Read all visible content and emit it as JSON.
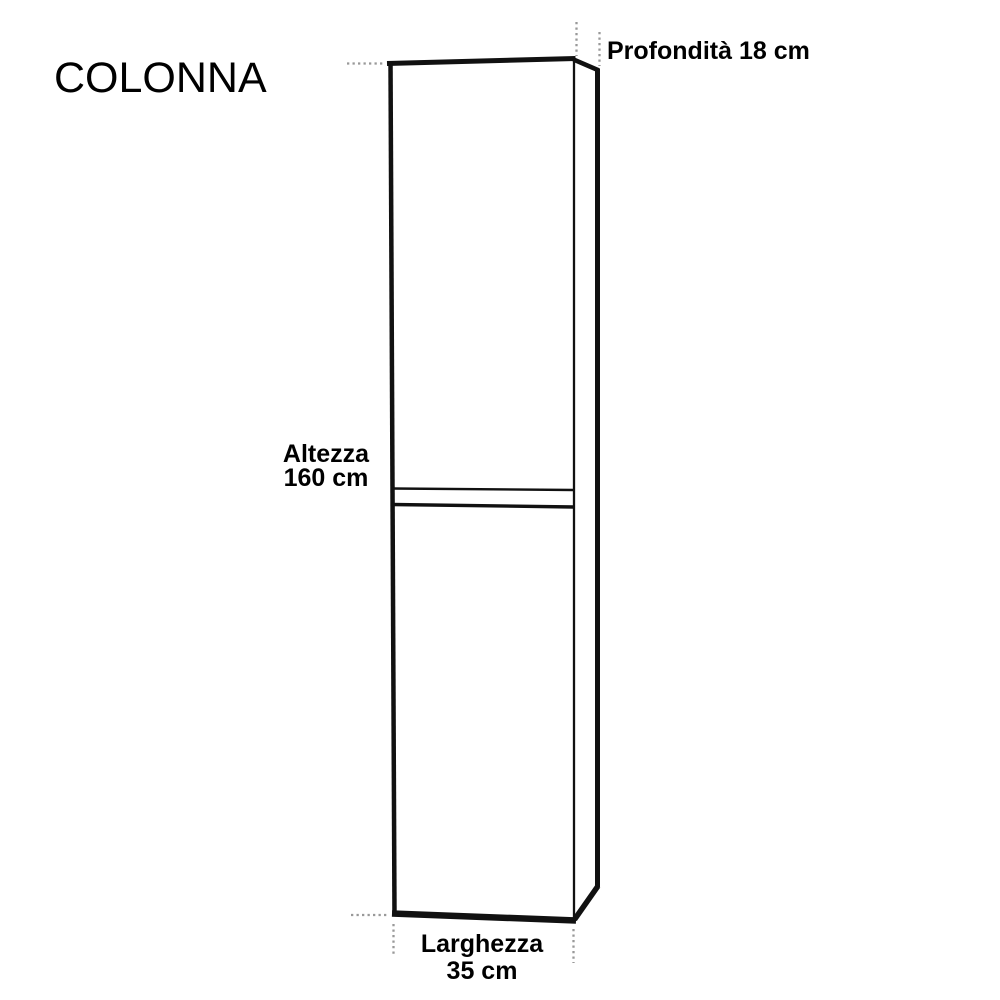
{
  "diagram": {
    "title": "COLONNA",
    "dimensions": {
      "depth": {
        "label": "Profondità",
        "value": "18 cm"
      },
      "height": {
        "label": "Altezza",
        "value": "160 cm"
      },
      "width": {
        "label": "Larghezza",
        "value": "35 cm"
      }
    },
    "colors": {
      "line": "#111111",
      "dash": "#999999",
      "text": "#000000",
      "background": "#ffffff"
    }
  }
}
